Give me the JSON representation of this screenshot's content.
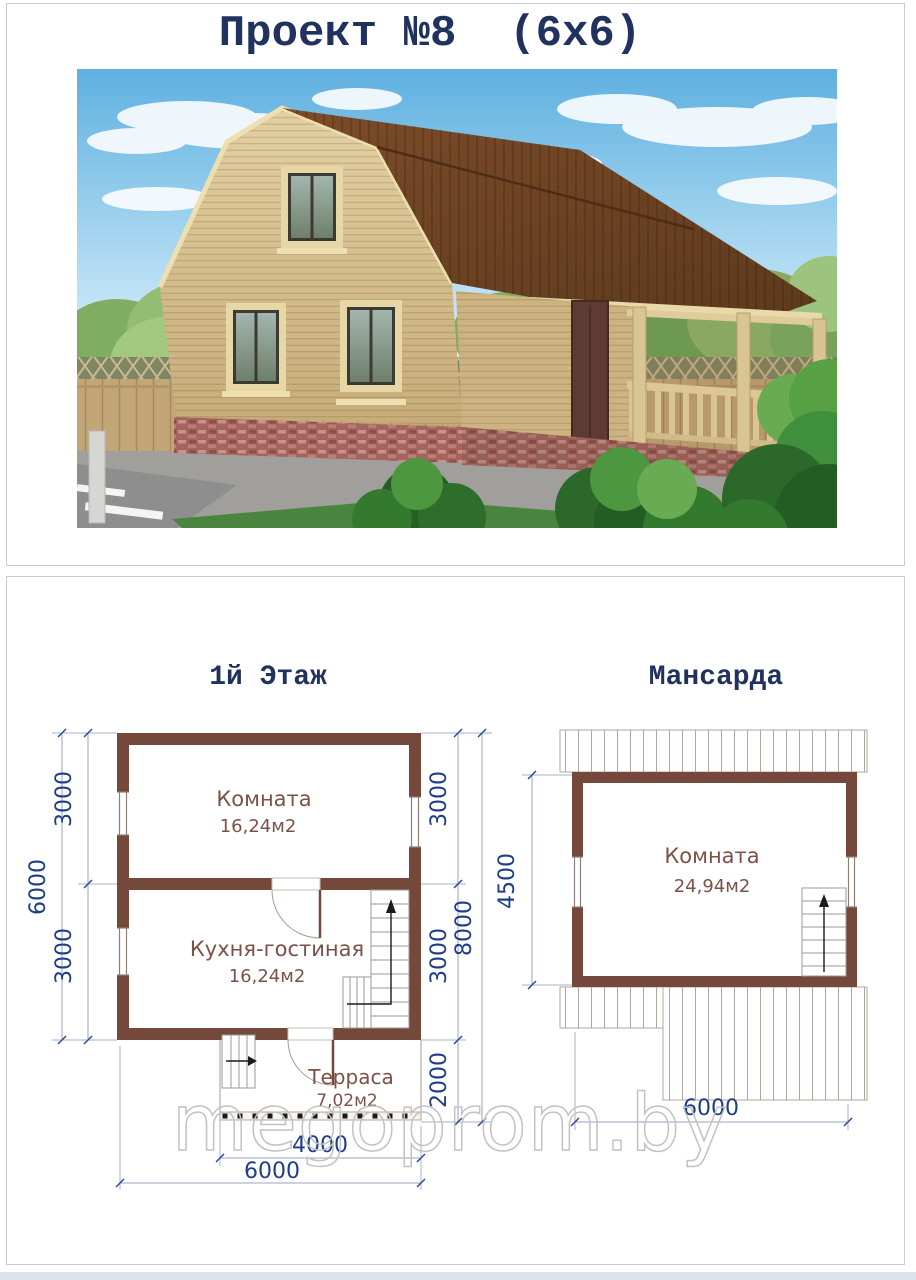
{
  "page": {
    "title": "Проект №8  (6x6)",
    "watermark": "megoprom.by"
  },
  "floor1": {
    "label": "1й Этаж",
    "room1_name": "Комната",
    "room1_area": "16,24м2",
    "room2_name": "Кухня-гостиная",
    "room2_area": "16,24м2",
    "terrace_name": "Терраса",
    "terrace_area": "7,02м2",
    "dim_left_upper": "3000",
    "dim_left_lower": "3000",
    "dim_left_total": "6000",
    "dim_right_upper": "3000",
    "dim_right_lower": "3000",
    "dim_right_terrace": "2000",
    "dim_right_total": "8000",
    "dim_terrace_width": "4000",
    "dim_width_total": "6000"
  },
  "attic": {
    "label": "Мансарда",
    "room_name": "Комната",
    "room_area": "24,94м2",
    "dim_height": "4500",
    "dim_width": "6000"
  },
  "colors": {
    "wall": "#74493c",
    "dimension_text": "#1e3e8a",
    "room_text": "#7b5148",
    "heading_text": "#21325f",
    "roof": "#6b4123",
    "watermark": "#c2c2c2"
  }
}
